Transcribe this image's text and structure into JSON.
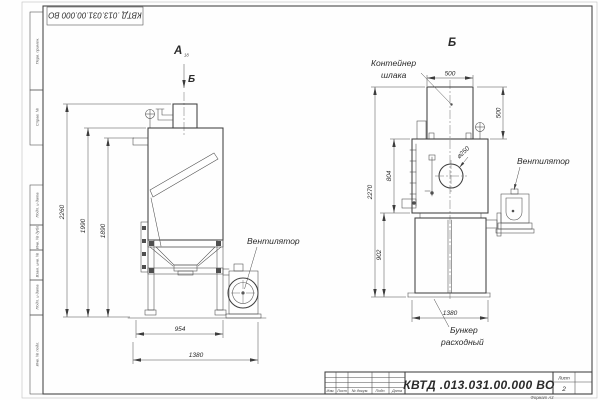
{
  "frame": {
    "top_stamp": "КВТД .013.031.00.000  ВО",
    "margin_labels": {
      "perv": "Перв. примен.",
      "sprav": "Справ. №",
      "podp1": "Подп. и дата",
      "inv_dubl": "Инв. № дубл.",
      "vzam": "Взам. инв. №",
      "podp2": "Подп. и дата",
      "inv_podl": "Инв. № подл."
    },
    "format_note": "Формат А3"
  },
  "view_a": {
    "label": "А",
    "label_sub": "18",
    "section_arrow": "Б",
    "fan_callout": "Вентилятор",
    "dim_height_overall": "2260",
    "dim_height_body": "1990",
    "dim_height_flange": "1890",
    "dim_width_stand": "954",
    "dim_width_overall": "1380"
  },
  "view_b": {
    "label": "Б",
    "container_callout_line1": "Контейнер",
    "container_callout_line2": "шлака",
    "fan_callout": "Вентилятор",
    "bunker_callout_line1": "Бункер",
    "bunker_callout_line2": "расходный",
    "dim_container_width": "500",
    "dim_container_height": "500",
    "dim_port": "⌀250",
    "dim_body_height": "804",
    "dim_height_overall": "2270",
    "dim_bunker_height": "902",
    "dim_width": "1380"
  },
  "title_block": {
    "doc_number": "КВТД .013.031.00.000  ВО",
    "sheet_label": "Лист",
    "sheet_number": "2",
    "col_izm": "Изм.",
    "col_list": "Лист",
    "col_ndoc": "№ докум.",
    "col_podp": "Подп.",
    "col_data": "Дата"
  }
}
